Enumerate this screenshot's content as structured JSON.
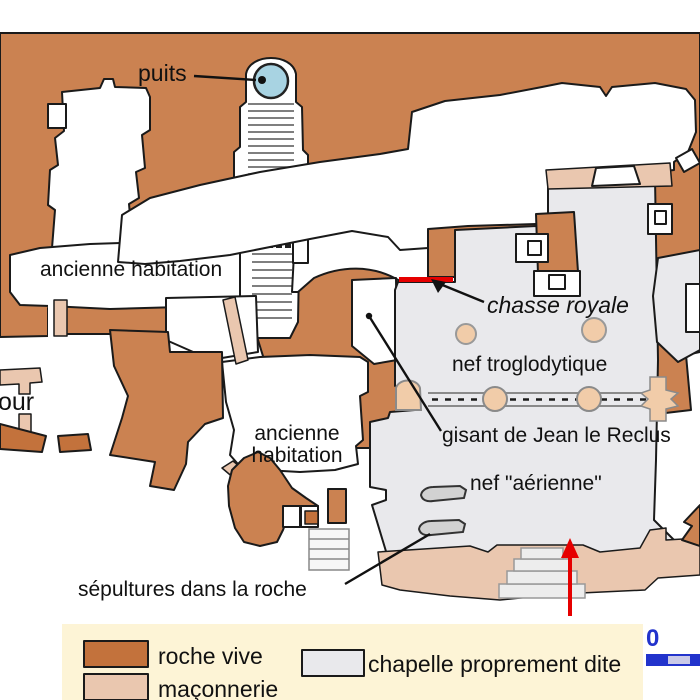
{
  "labels": {
    "puits": "puits",
    "habitation_1": "ancienne habitation",
    "habitation_2_line1": "ancienne",
    "habitation_2_line2": "habitation",
    "tour_clipped": "our",
    "chasse_royale": "chasse royale",
    "nef_troglodytique": "nef troglodytique",
    "gisant": "gisant de Jean le Reclus",
    "nef_aerienne": "nef \"aérienne\"",
    "sepultures": "sépultures dans la roche"
  },
  "legend": {
    "items": [
      {
        "label": "roche vive",
        "color": "#c3723c"
      },
      {
        "label": "maçonnerie",
        "color": "#eac7af"
      },
      {
        "label": "chapelle proprement dite",
        "color": "#e9e9ec"
      }
    ],
    "scale_zero": "0"
  },
  "colors": {
    "rock": "#cb8251",
    "rock_dark": "#c3723c",
    "masonry": "#eac7af",
    "column": "#f1cca9",
    "chapel": "#e9e9ec",
    "tomb": "#d2d2d2",
    "well_water": "#a8d3e2",
    "accent_red": "#e60000",
    "legend_bg": "#fdf4d6",
    "scale_blue": "#2233cc",
    "outline": "#1a1a1a"
  }
}
